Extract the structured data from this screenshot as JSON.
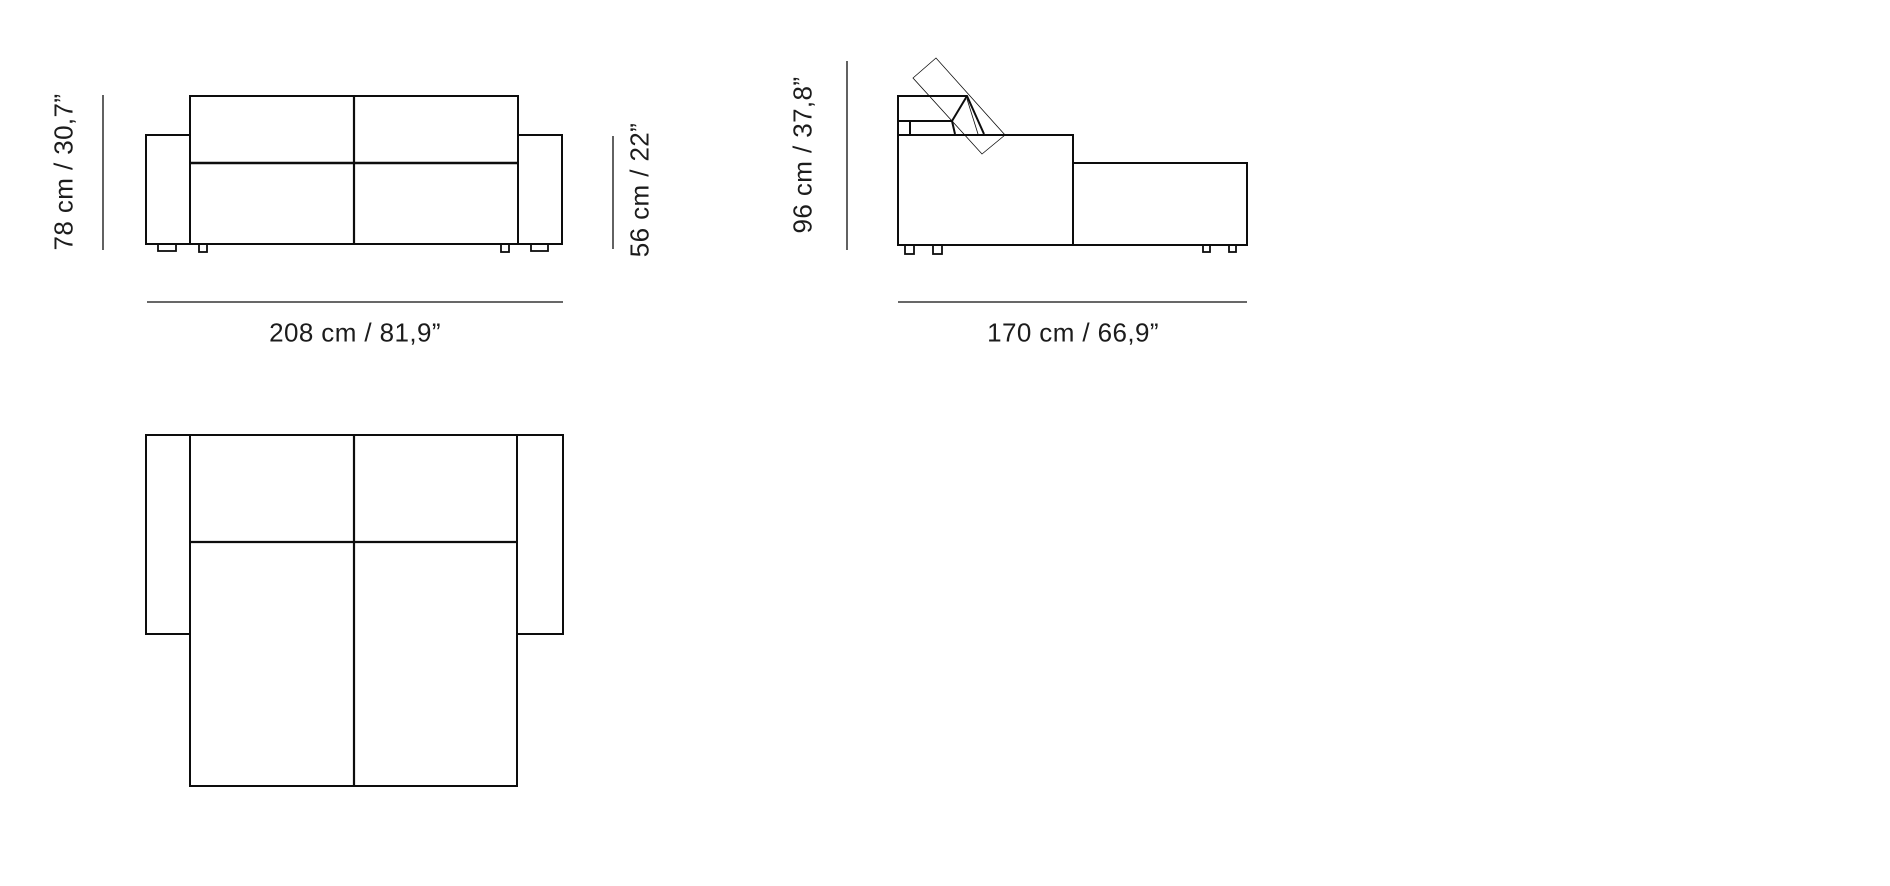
{
  "diagram": {
    "type": "furniture-dimension-drawing",
    "subject": "sofa-bed with ottoman, front / side / top technical views",
    "colors": {
      "background": "#ffffff",
      "line": "#0d0d0d",
      "text": "#1c1c1c"
    },
    "front_view": {
      "height_label": "78 cm / 30,7”",
      "height_cm": 78,
      "height_in": "30,7",
      "arm_height_label": "56 cm / 22”",
      "arm_height_cm": 56,
      "arm_height_in": "22",
      "width_label": "208 cm / 81,9”",
      "width_cm": 208,
      "width_in": "81,9"
    },
    "side_view": {
      "height_label": "96 cm / 37,8”",
      "height_cm": 96,
      "height_in": "37,8",
      "depth_label": "170 cm / 66,9”",
      "depth_cm": 170,
      "depth_in": "66,9"
    }
  }
}
